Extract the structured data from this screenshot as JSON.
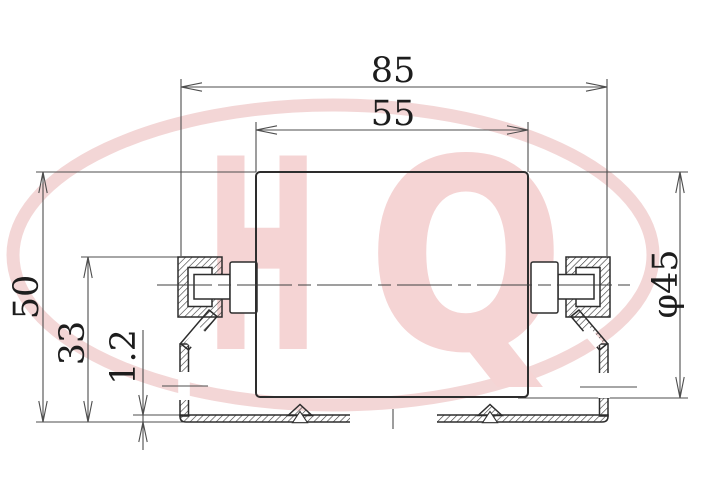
{
  "drawing": {
    "type": "technical-cross-section",
    "subject": "conveyor roller mounted in C-channel rail",
    "dimensions": {
      "rail_outer_width": {
        "label": "85"
      },
      "roller_face_length": {
        "label": "55"
      },
      "overall_height": {
        "label": "50"
      },
      "rail_edge_height": {
        "label": "33"
      },
      "sheet_thickness": {
        "label": "1.2"
      },
      "roller_diameter": {
        "label": "φ45"
      }
    },
    "watermark": {
      "brand": "HQ",
      "letter_h": "H",
      "letter_q": "Q",
      "ring_color": "#f3d6d6",
      "letter_color": "#f5d4d4"
    },
    "colors": {
      "outline": "#2d2d2d",
      "hatch": "#3c3c3c",
      "dimension_lines": "#4d4d4d",
      "text": "#1d1d1d",
      "background": "#ffffff"
    }
  }
}
